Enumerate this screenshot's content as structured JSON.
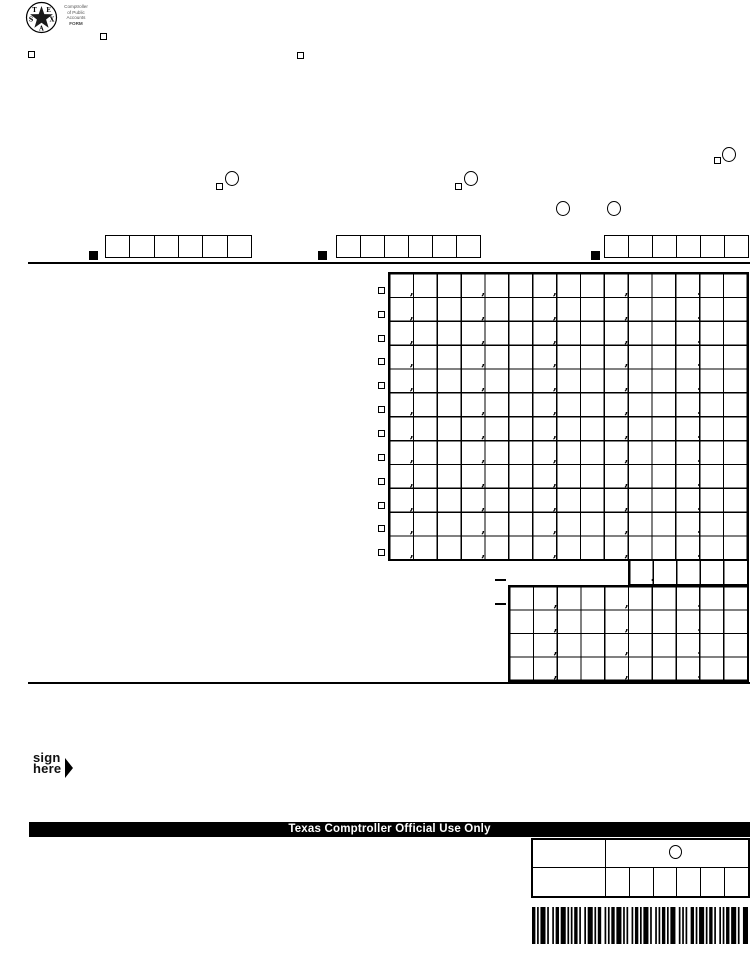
{
  "page": {
    "bg": "#ffffff",
    "ink": "#000000"
  },
  "logo": {
    "star_letters": [
      "T",
      "E",
      "X",
      "A",
      "S"
    ],
    "org_lines": [
      "Comptroller",
      "of Public",
      "Accounts",
      "FORM"
    ]
  },
  "glyphs": {
    "comma": ",",
    "decimal": "."
  },
  "grids": {
    "main": {
      "rows": 12,
      "cols": 15,
      "cell_w": 23.85,
      "cell_h": 23.85,
      "comma_cols": [
        1,
        4,
        7,
        10
      ],
      "decimal_col": 13,
      "row_checkboxes": true
    },
    "rate": {
      "rows": 1,
      "cols": 5,
      "cell_w": 23.56,
      "cell_h": 22.2,
      "comma_cols": [],
      "decimal_col": 1,
      "row_checkboxes": false
    },
    "summary": {
      "rows": 4,
      "cols": 10,
      "cell_w": 23.78,
      "cell_h": 23.43,
      "comma_cols": [
        2,
        5
      ],
      "decimal_col": 8,
      "row_checkboxes": false
    }
  },
  "sign_here": {
    "line1": "sign",
    "line2": "here"
  },
  "official_use": {
    "bar_label": "Texas Comptroller Official Use Only"
  },
  "barcode": {
    "pattern": [
      2,
      1,
      1,
      1,
      3,
      1,
      1,
      2,
      1,
      1,
      2,
      1,
      3,
      1,
      1,
      1,
      1,
      1,
      2,
      1,
      1,
      2,
      1,
      1,
      3,
      1,
      1,
      1,
      2,
      2,
      1,
      1,
      1,
      1,
      2,
      1,
      3,
      1,
      1,
      1,
      1,
      2,
      1,
      1,
      2,
      1,
      1,
      1,
      3,
      1,
      1,
      2,
      1,
      1,
      1,
      1,
      2,
      1,
      1,
      1,
      3,
      2,
      1,
      1,
      1,
      1,
      1,
      2,
      2,
      1,
      1,
      1,
      3,
      1,
      1,
      1,
      2,
      1,
      1,
      2,
      1,
      1,
      1,
      1,
      2,
      1,
      3,
      1,
      1,
      2,
      3
    ]
  }
}
